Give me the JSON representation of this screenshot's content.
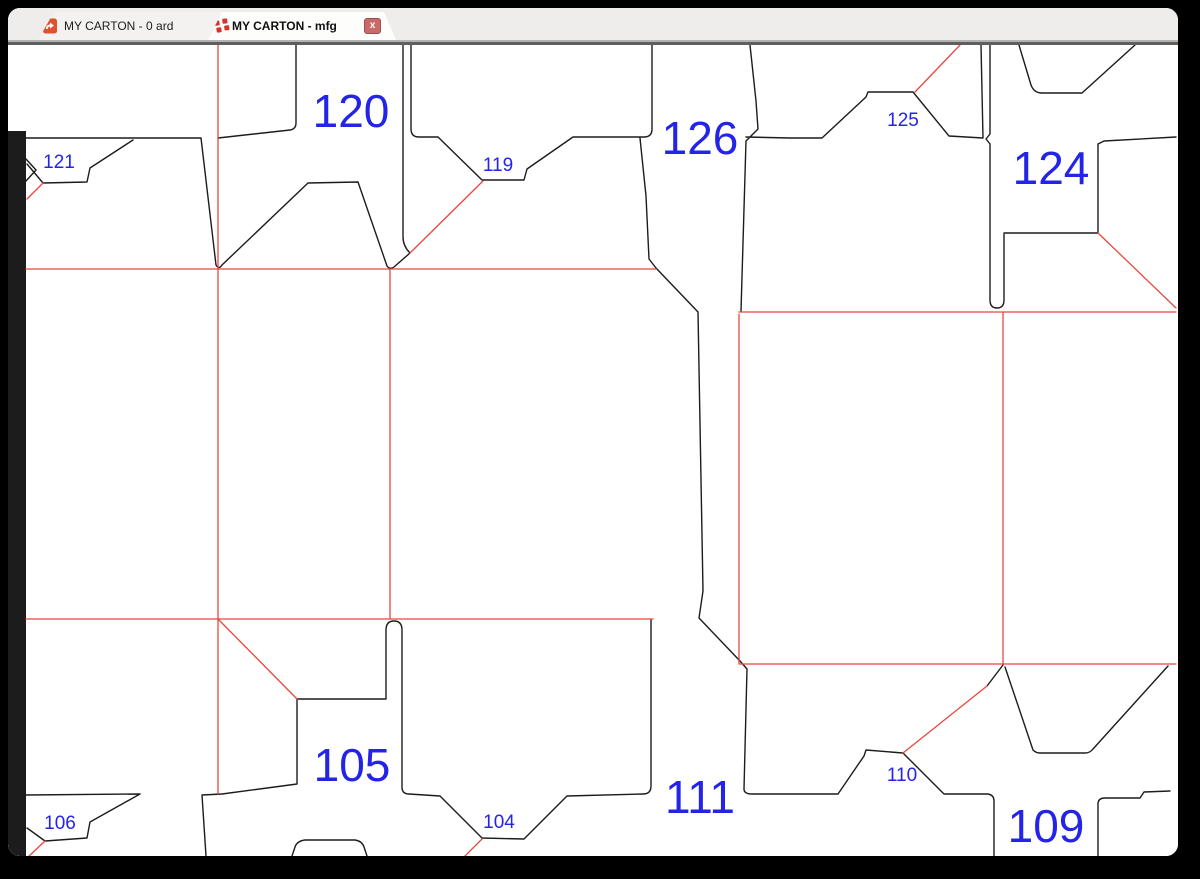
{
  "window": {
    "tabs": [
      {
        "label": "MY CARTON - 0 ard",
        "icon": "ard-document-icon",
        "active": false
      },
      {
        "label": "MY CARTON - mfg",
        "icon": "mfg-layout-icon",
        "active": true,
        "close_label": "x"
      }
    ]
  },
  "colors": {
    "cut_line": "#1c1c1c",
    "crease_line": "#e8473d",
    "label_blue": "#2424e8",
    "tab_bar_bg": "#efedeb",
    "inactive_tab_bg": "#f4f2f0",
    "active_tab_bg": "#fdfdfc",
    "close_button_bg": "#c96a6a",
    "close_button_border": "#a04e4e",
    "window_bg": "#ffffff",
    "frame": "#000000"
  },
  "canvas": {
    "labels": [
      {
        "id": "120",
        "x": 351,
        "y": 126,
        "size": "large"
      },
      {
        "id": "126",
        "x": 700,
        "y": 153,
        "size": "large"
      },
      {
        "id": "124",
        "x": 1051,
        "y": 183,
        "size": "large"
      },
      {
        "id": "105",
        "x": 352,
        "y": 780,
        "size": "large"
      },
      {
        "id": "111",
        "x": 700,
        "y": 812,
        "size": "large"
      },
      {
        "id": "109",
        "x": 1046,
        "y": 841,
        "size": "large"
      },
      {
        "id": "121",
        "x": 59,
        "y": 167,
        "size": "small"
      },
      {
        "id": "119",
        "x": 498,
        "y": 170,
        "size": "small"
      },
      {
        "id": "125",
        "x": 903,
        "y": 125,
        "size": "small"
      },
      {
        "id": "106",
        "x": 60,
        "y": 828,
        "size": "small"
      },
      {
        "id": "104",
        "x": 499,
        "y": 827,
        "size": "small"
      },
      {
        "id": "110",
        "x": 902,
        "y": 780,
        "size": "small"
      }
    ]
  }
}
